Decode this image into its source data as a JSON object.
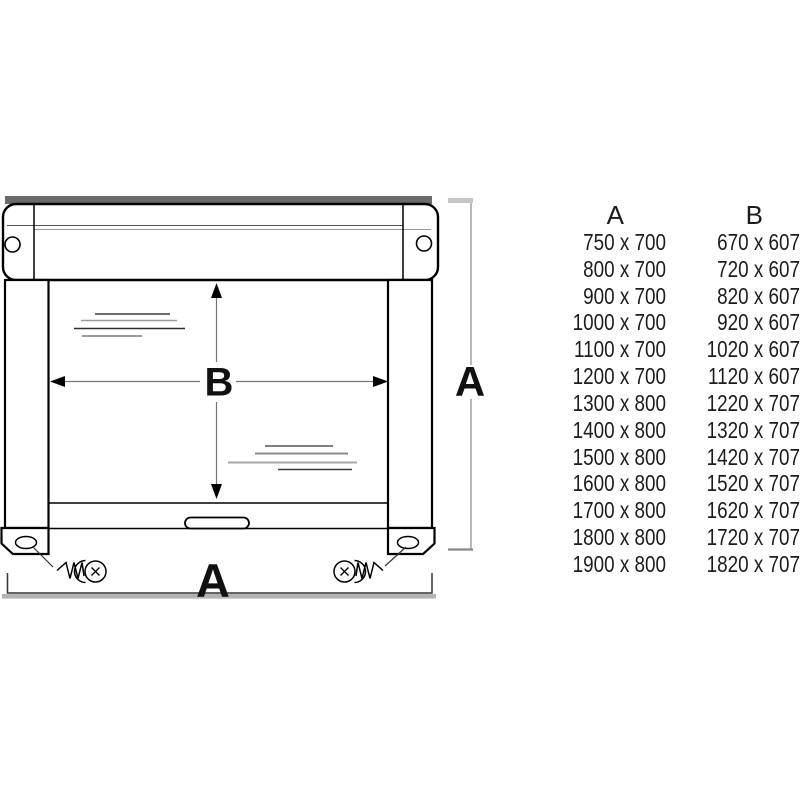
{
  "colors": {
    "background": "#ffffff",
    "headrail_cap_gray": "#6b6b6b",
    "dimension_line_gray": "#999999",
    "tick_light_gray": "#c6c6c6",
    "baseline_bar_gray": "#b3b3b3",
    "outline_black": "#000000",
    "text": "#1c1c1c"
  },
  "diagram": {
    "labels": {
      "inner_width": "B",
      "outer_height": "A",
      "outer_width": "A"
    },
    "icons": {
      "left_fixing": "screw-icon",
      "right_fixing": "screw-icon",
      "left_foot_hole": "mounting-hole-icon",
      "right_foot_hole": "mounting-hole-icon",
      "headrail_left_hole": "screw-hole-icon",
      "headrail_right_hole": "screw-hole-icon"
    }
  },
  "size_table": {
    "header_a": "A",
    "header_b": "B",
    "rows": [
      {
        "a": "750 x 700",
        "b": "670 x 607"
      },
      {
        "a": "800 x 700",
        "b": "720 x 607"
      },
      {
        "a": "900 x 700",
        "b": "820 x 607"
      },
      {
        "a": "1000 x 700",
        "b": "920 x 607"
      },
      {
        "a": "1100 x 700",
        "b": "1020 x 607"
      },
      {
        "a": "1200 x 700",
        "b": "1120 x 607"
      },
      {
        "a": "1300 x 800",
        "b": "1220 x 707"
      },
      {
        "a": "1400 x 800",
        "b": "1320 x 707"
      },
      {
        "a": "1500 x 800",
        "b": "1420 x 707"
      },
      {
        "a": "1600 x 800",
        "b": "1520 x 707"
      },
      {
        "a": "1700 x 800",
        "b": "1620 x 707"
      },
      {
        "a": "1800 x 800",
        "b": "1720 x 707"
      },
      {
        "a": "1900 x 800",
        "b": "1820 x 707"
      }
    ]
  }
}
